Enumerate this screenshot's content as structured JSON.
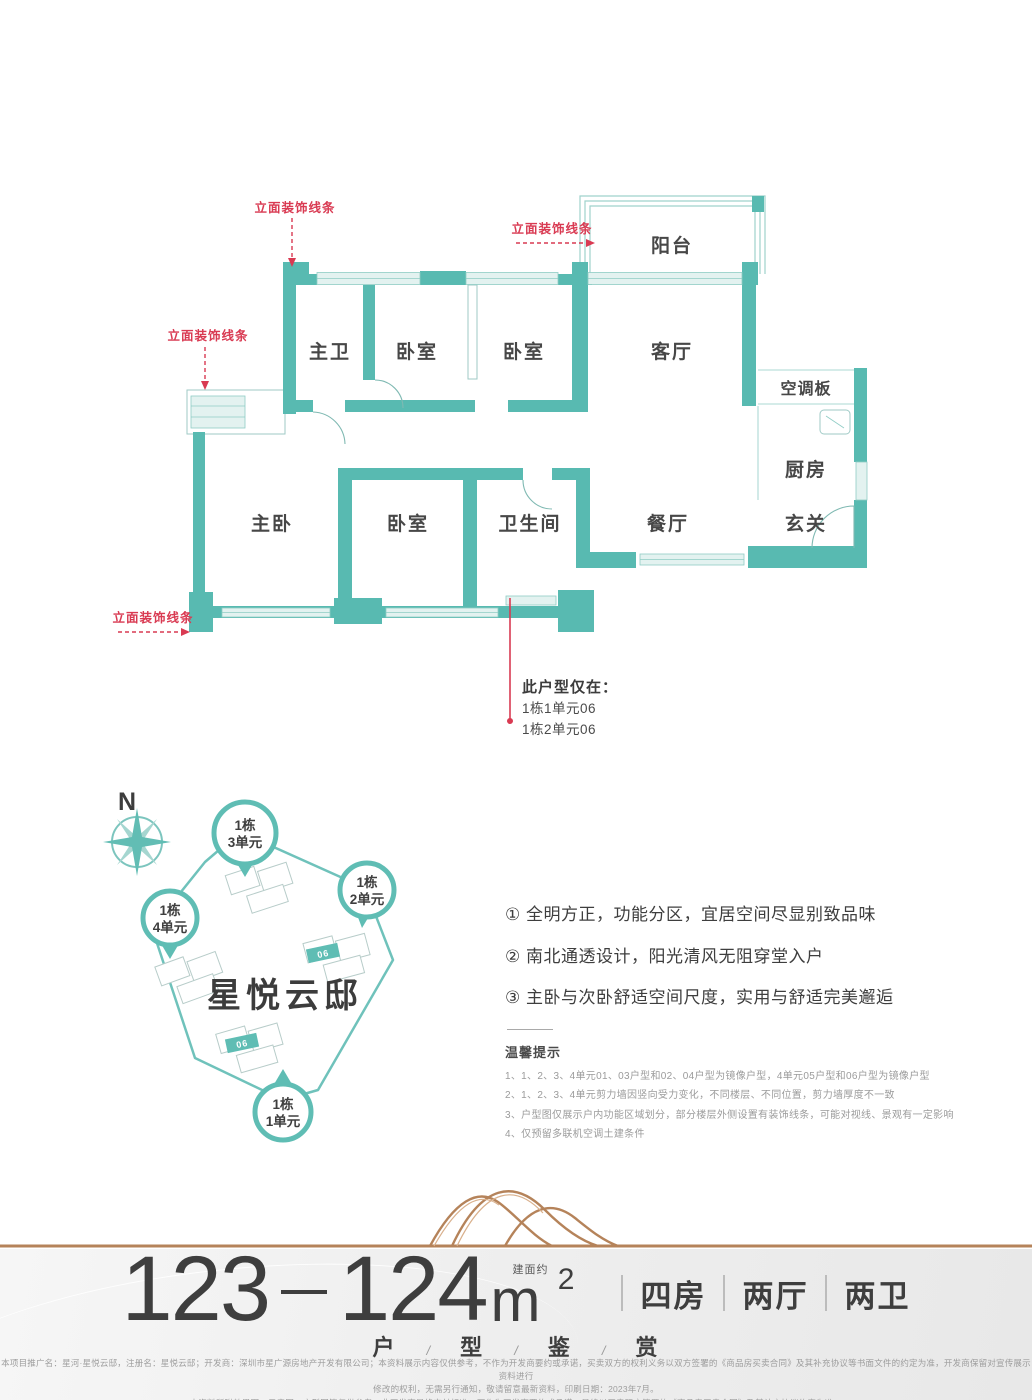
{
  "colors": {
    "wall_teal": "#58bab1",
    "window_teal": "#e3f2f0",
    "annotation_red": "#d93a52",
    "copper": "#b5835a",
    "text_dark": "#3e3e3e",
    "text_gray": "#9b9b9b"
  },
  "floor_plan": {
    "facade_line_label": "立面装饰线条",
    "rooms": [
      {
        "label": "主卫"
      },
      {
        "label": "卧室"
      },
      {
        "label": "卧室"
      },
      {
        "label": "客厅"
      },
      {
        "label": "阳台"
      },
      {
        "label": "空调板"
      },
      {
        "label": "厨房"
      },
      {
        "label": "主卧"
      },
      {
        "label": "卧室"
      },
      {
        "label": "卫生间"
      },
      {
        "label": "餐厅"
      },
      {
        "label": "玄关"
      }
    ],
    "unit_note": {
      "title": "此户型仅在：",
      "lines": [
        "1栋1单元06",
        "1栋2单元06"
      ]
    }
  },
  "site_plan": {
    "compass": "N",
    "project_name": "星悦云邸",
    "unit_tag": "06",
    "markers": [
      {
        "line1": "1栋",
        "line2": "3单元"
      },
      {
        "line1": "1栋",
        "line2": "2单元"
      },
      {
        "line1": "1栋",
        "line2": "4单元"
      },
      {
        "line1": "1栋",
        "line2": "1单元"
      }
    ]
  },
  "selling_points": [
    "① 全明方正，功能分区，宜居空间尽显别致品味",
    "② 南北通透设计，阳光清风无阻穿堂入户",
    "③ 主卧与次卧舒适空间尺度，实用与舒适完美邂逅"
  ],
  "tips": {
    "title": "温馨提示",
    "items": [
      "1、1、2、3、4单元01、03户型和02、04户型为镜像户型，4单元05户型和06户型为镜像户型",
      "2、1、2、3、4单元剪力墙因竖向受力变化，不同楼层、不同位置，剪力墙厚度不一致",
      "3、户型图仅展示户内功能区域划分，部分楼层外侧设置有装饰线条，可能对视线、景观有一定影响",
      "4、仅预留多联机空调土建条件"
    ]
  },
  "footer": {
    "area": {
      "min": "123",
      "max": "124",
      "approx": "建面约",
      "unit": "m",
      "sup": "2"
    },
    "specs": [
      "四房",
      "两厅",
      "两卫"
    ],
    "tagline": [
      "户",
      "型",
      "鉴",
      "赏"
    ],
    "tagline_sep": "/",
    "disclaimer": [
      "本项目推广名：星河·星悦云邸，注册名：星悦云邸；开发商：深圳市星广源房地产开发有限公司；本资料展示内容仅供参考，不作为开发商要约或承诺，买卖双方的权利义务以双方签署的《商品房买卖合同》及其补充协议等书面文件的约定为准，开发商保留对宣传展示资料进行",
      "修改的权利，无需另行通知，敬请留意最新资料，印刷日期：2023年7月。",
      "本资料所附效果图、示意图、户型图等仅供参考，非开发商最终交付标准，不作为开发商要约或承诺，最终以买卖双方签署的《商品房买卖合同》及其补充协议约定为准。"
    ]
  }
}
